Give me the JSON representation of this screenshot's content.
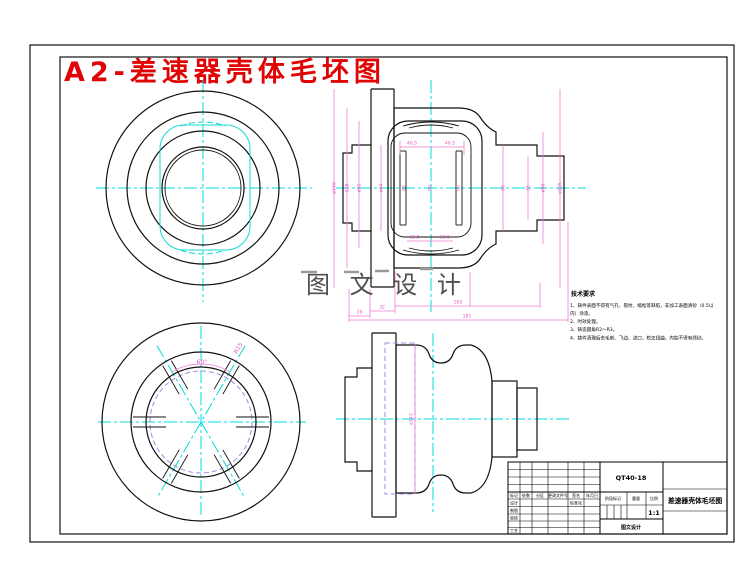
{
  "sheet": {
    "title": "A2-差速器壳体毛坯图"
  },
  "watermark": {
    "text": "图 文 设 计"
  },
  "dims": {
    "s_top_l": "40.5",
    "s_top_r": "40.5",
    "s_bot_l": "22.5",
    "s_bot_r": "22.5",
    "s_left_1": "ø146",
    "s_left_2": "118",
    "s_left_3": "ø92",
    "s_left_4": "ø64",
    "s_mid_1": "65",
    "s_mid_2": "80",
    "s_mid_3": "65",
    "s_right_1": "60",
    "s_right_2": "35",
    "s_right_3": "ø90",
    "s_right_4": "ø105",
    "c_19": "19",
    "c_32": "32",
    "c_165": "165",
    "c_181": "181",
    "w_angle": "60°",
    "w_r": "R15",
    "d_side": "ø143"
  },
  "tech_notes": {
    "title": "技术要求",
    "lines": [
      "1、铸件表面不得有气孔、裂纹、缩松等缺陷，非加工表面清砂（0.5以",
      "内）涂漆。",
      "2、时效处理。",
      "3、铸造圆角R2～R3。",
      "4、铸件清理后去毛刺、飞边、浇口，校正扭曲，内腔不得有残砂。"
    ]
  },
  "title_block": {
    "material": "QT40-18",
    "drawing_name": "差速器壳体毛坯图",
    "scale": "1:1",
    "stage_label": "阶段标记",
    "weight_label": "重量",
    "scale_label": "比例",
    "company": "图文设计",
    "std_label": "标准化",
    "header": [
      "标记",
      "处数",
      "分区",
      "更改文件号",
      "签名",
      "年月日"
    ],
    "row_labels": [
      "设计",
      "制图",
      "审核",
      "工艺"
    ]
  }
}
